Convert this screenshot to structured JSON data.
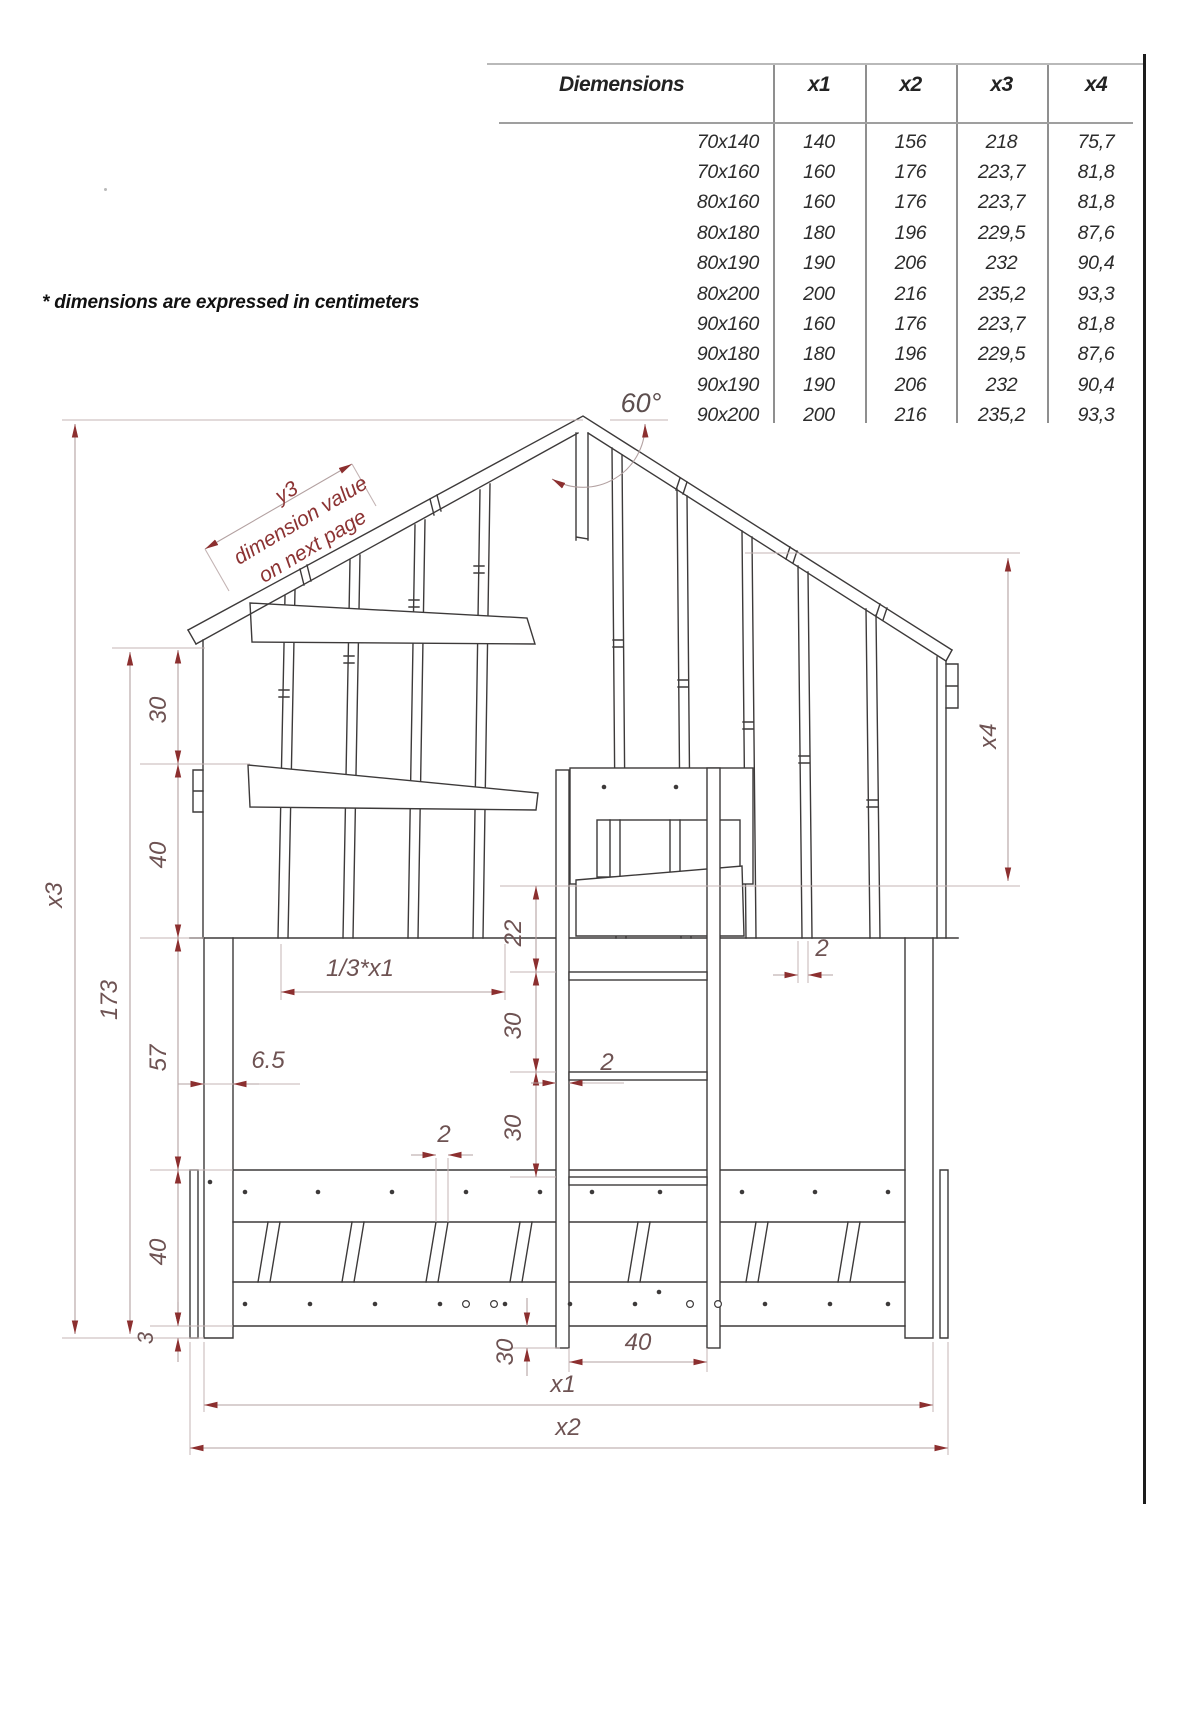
{
  "note": "* dimensions are expressed in centimeters",
  "table": {
    "header": [
      "Diemensions",
      "x1",
      "x2",
      "x3",
      "x4"
    ],
    "rows": [
      [
        "70x140",
        "140",
        "156",
        "218",
        "75,7"
      ],
      [
        "70x160",
        "160",
        "176",
        "223,7",
        "81,8"
      ],
      [
        "80x160",
        "160",
        "176",
        "223,7",
        "81,8"
      ],
      [
        "80x180",
        "180",
        "196",
        "229,5",
        "87,6"
      ],
      [
        "80x190",
        "190",
        "206",
        "232",
        "90,4"
      ],
      [
        "80x200",
        "200",
        "216",
        "235,2",
        "93,3"
      ],
      [
        "90x160",
        "160",
        "176",
        "223,7",
        "81,8"
      ],
      [
        "90x180",
        "180",
        "196",
        "229,5",
        "87,6"
      ],
      [
        "90x190",
        "190",
        "206",
        "232",
        "90,4"
      ],
      [
        "90x200",
        "200",
        "216",
        "235,2",
        "93,3"
      ]
    ]
  },
  "drawing": {
    "labels": {
      "angle": "60°",
      "y3": "y3",
      "y3_note1": "dimension value",
      "y3_note2": "on next page",
      "x3": "x3",
      "h173": "173",
      "c30": "30",
      "c40a": "40",
      "c57": "57",
      "c40b": "40",
      "c3": "3",
      "third_x1": "1/3*x1",
      "d65": "6.5",
      "d22": "22",
      "d30a": "30",
      "d30b": "30",
      "d2_ladder": "2",
      "d2_slat": "2",
      "d2_plank": "2",
      "d40_ladder": "40",
      "d30_bottom": "30",
      "x1": "x1",
      "x2": "x2",
      "x4": "x4"
    },
    "colors": {
      "structure_line": "#3d3a3a",
      "dimension_line": "#b3a1a1",
      "arrow_accent": "#8c2f2f",
      "dimension_text": "#6e5353",
      "roof_note_text": "#8c3333"
    }
  }
}
